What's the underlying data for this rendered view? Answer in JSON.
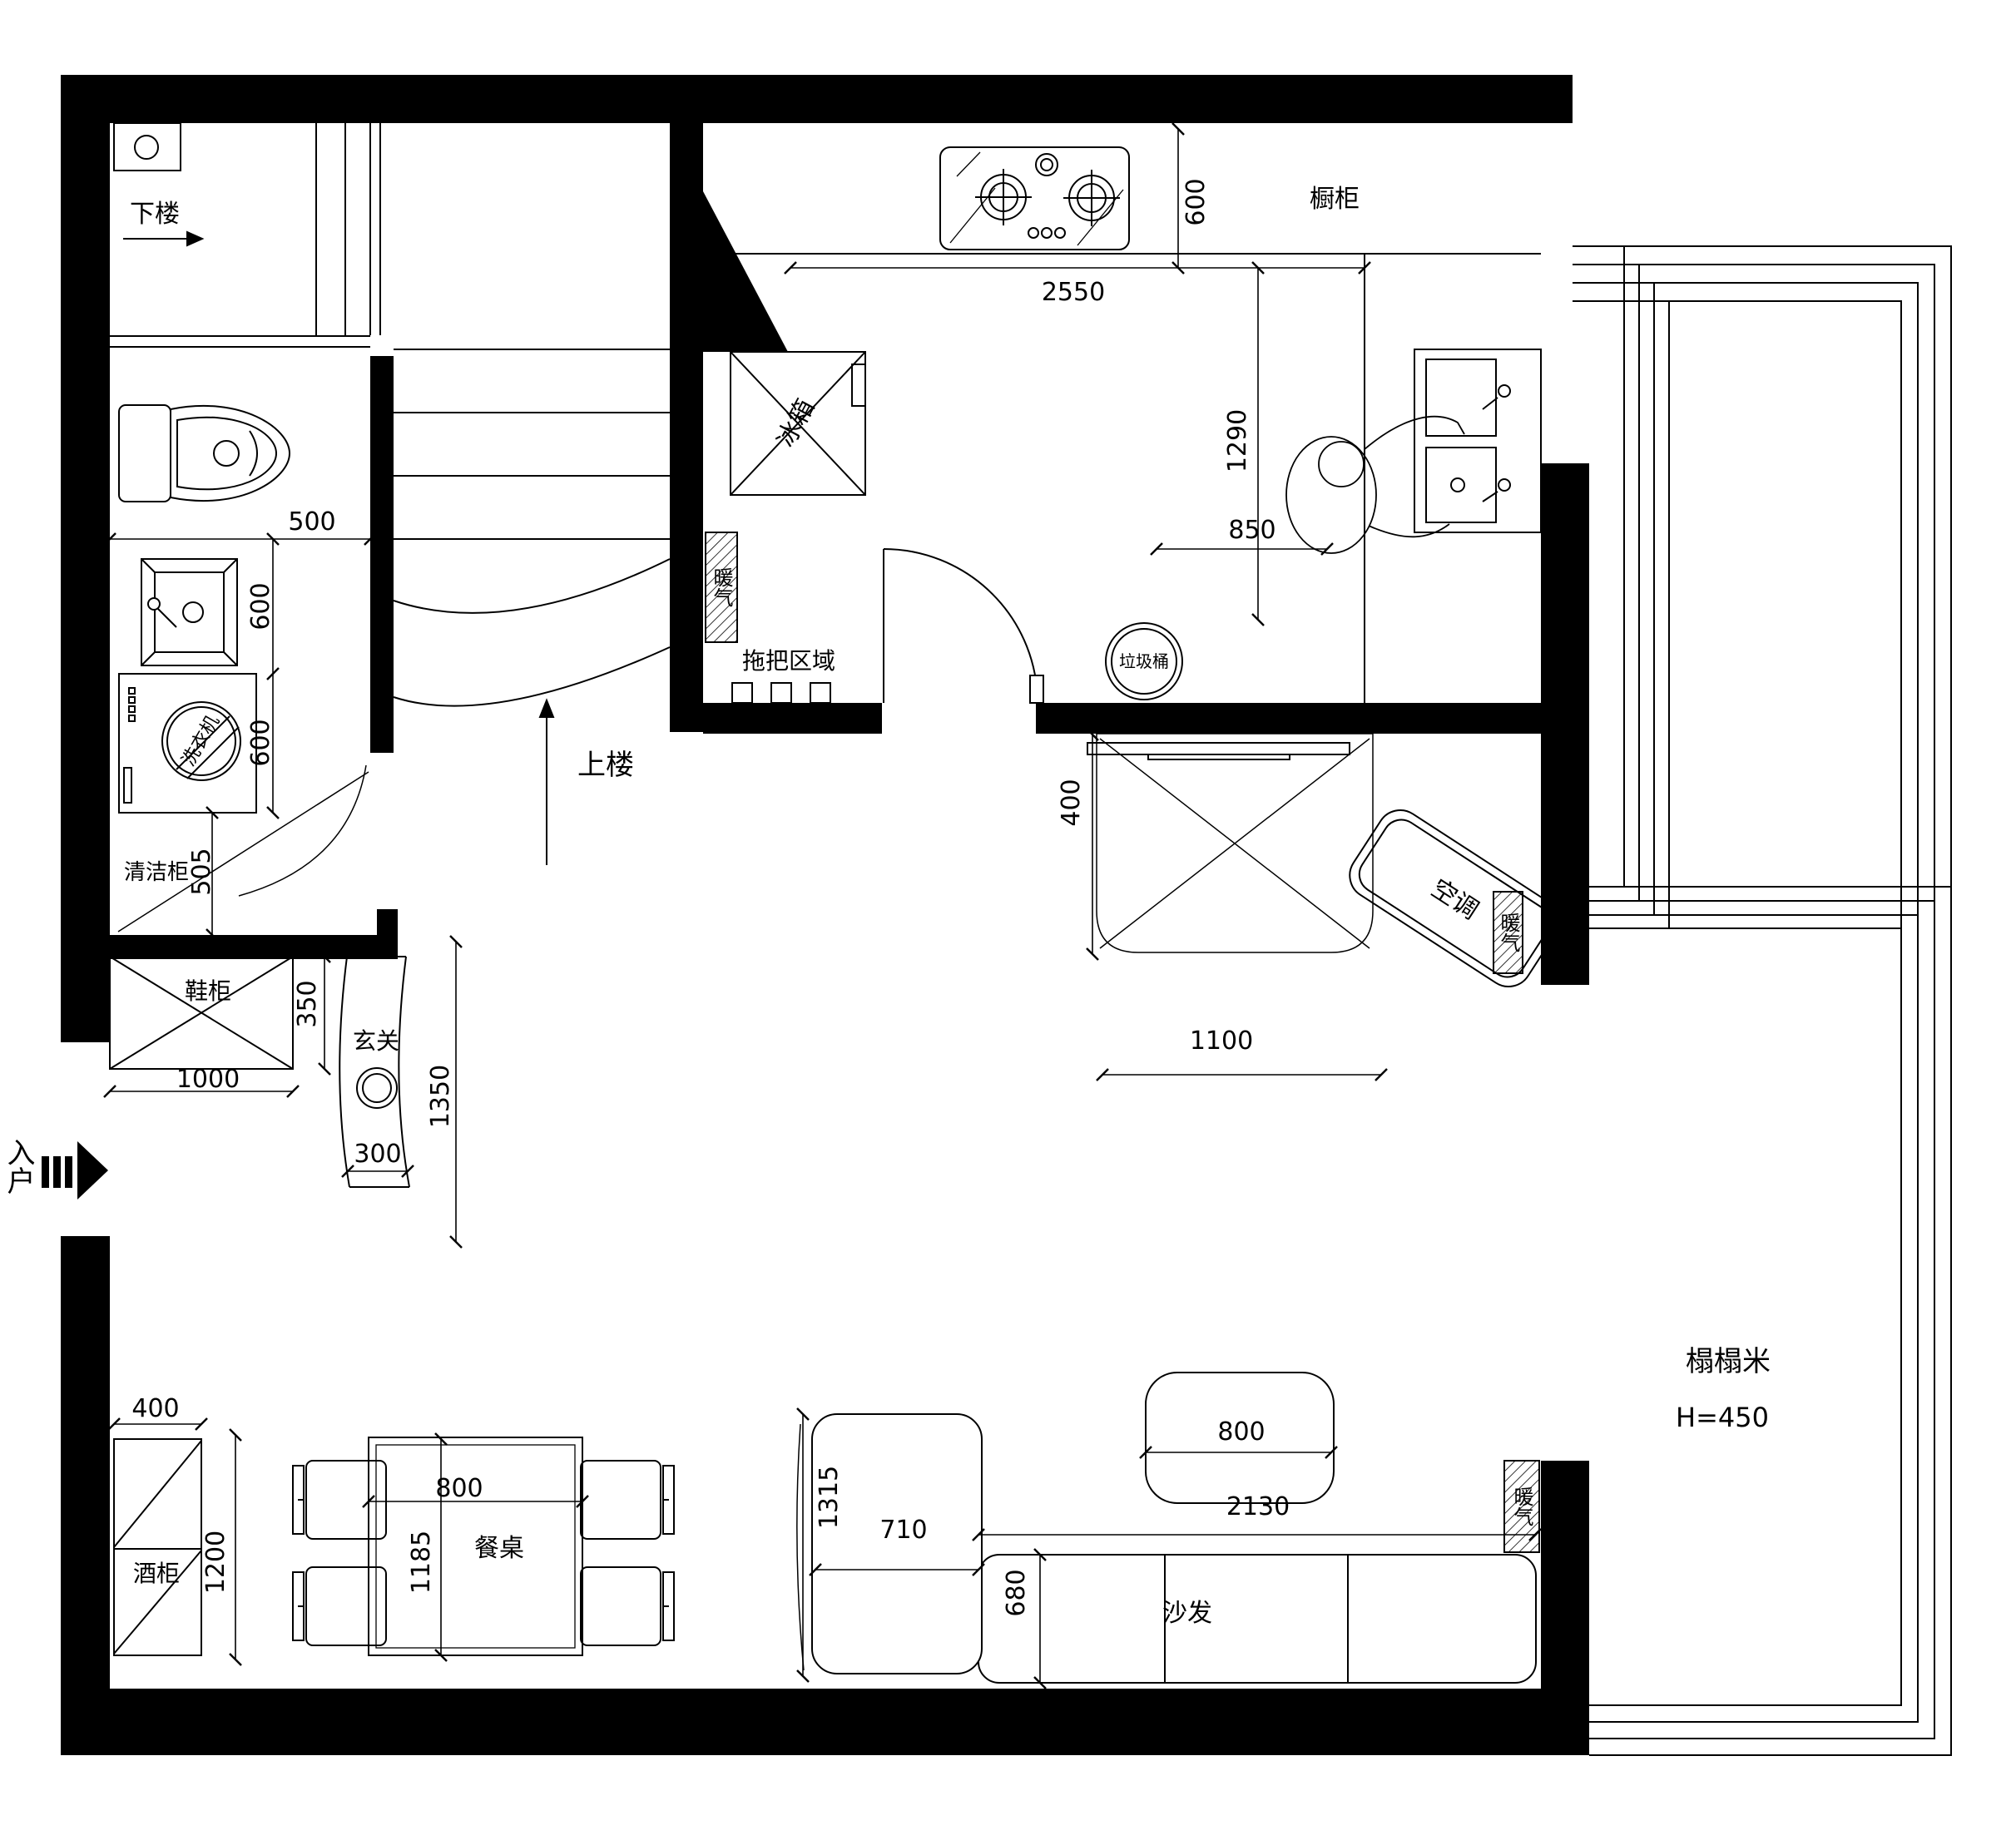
{
  "drawing": {
    "type": "apartment floor plan (duplex lower level)",
    "labels": {
      "stairs_down": "下楼",
      "stairs_up": "上楼",
      "entry": "入户",
      "entrance_screen": "玄关",
      "shoe_cabinet": "鞋柜",
      "cleaning_cabinet": "清洁柜",
      "washing_machine": "洗衣机",
      "fridge": "冰箱",
      "kitchen_cabinet": "橱柜",
      "heater": "暖气",
      "mop_area": "拖把区域",
      "trash_bin": "垃圾桶",
      "air_conditioner": "空调",
      "tatami": "榻榻米",
      "tatami_height": "H=450",
      "sofa": "沙发",
      "dining_table": "餐桌",
      "wine_cabinet": "酒柜"
    },
    "dimensions": {
      "toilet_zone_width": "500",
      "bath_sink_depth": "600",
      "washer_depth": "600",
      "cleaning_zone": "505",
      "shoe_cabinet_width": "1000",
      "shoe_cabinet_depth": "350",
      "screen_width": "300",
      "screen_length": "1350",
      "counter_depth": "600",
      "counter_length": "2550",
      "kitchen_island_length": "1290",
      "kitchen_island_width": "850",
      "tv_zone_depth": "400",
      "tv_zone_width": "1100",
      "coffee_table_width": "800",
      "sofa_length": "2130",
      "chaise_length": "1315",
      "chaise_width": "710",
      "sofa_depth": "680",
      "wine_cabinet_width": "400",
      "wine_cabinet_length": "1200",
      "dining_table_width": "800",
      "dining_table_length": "1185"
    }
  }
}
